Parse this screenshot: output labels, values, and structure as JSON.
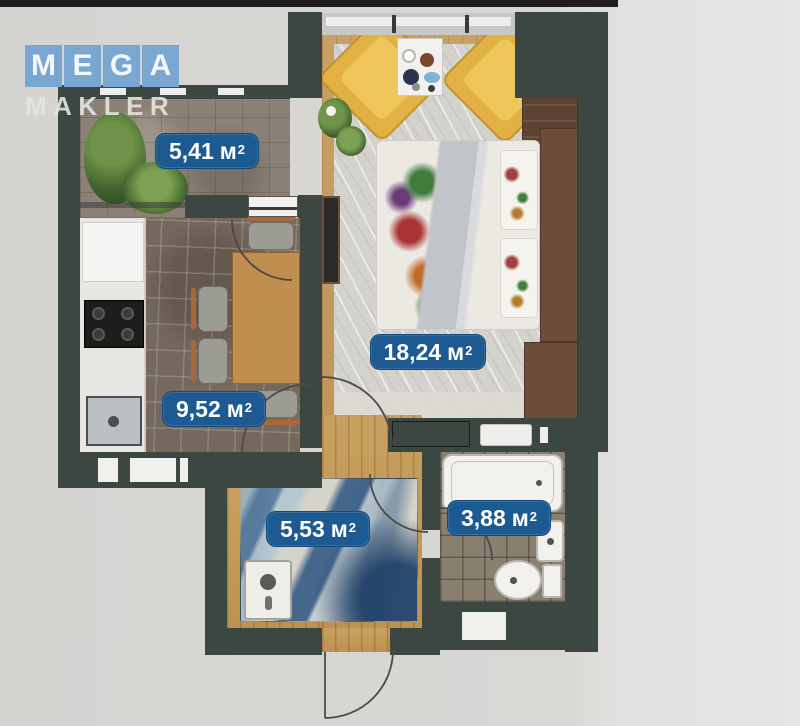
{
  "watermark": {
    "letters": [
      "M",
      "E",
      "G",
      "A"
    ],
    "line2": "MAKLER",
    "tile_color": "#79a7d1"
  },
  "floor_plan": {
    "label_bg": "#1d5a92",
    "label_text_color": "#ffffff",
    "superscript": "2",
    "rooms": [
      {
        "name": "balcony",
        "area_value": "5,41",
        "area_unit": "м"
      },
      {
        "name": "living-room",
        "area_value": "18,24",
        "area_unit": "м"
      },
      {
        "name": "kitchen",
        "area_value": "9,52",
        "area_unit": "м"
      },
      {
        "name": "hallway",
        "area_value": "5,53",
        "area_unit": "м"
      },
      {
        "name": "bathroom",
        "area_value": "3,88",
        "area_unit": "м"
      }
    ]
  }
}
